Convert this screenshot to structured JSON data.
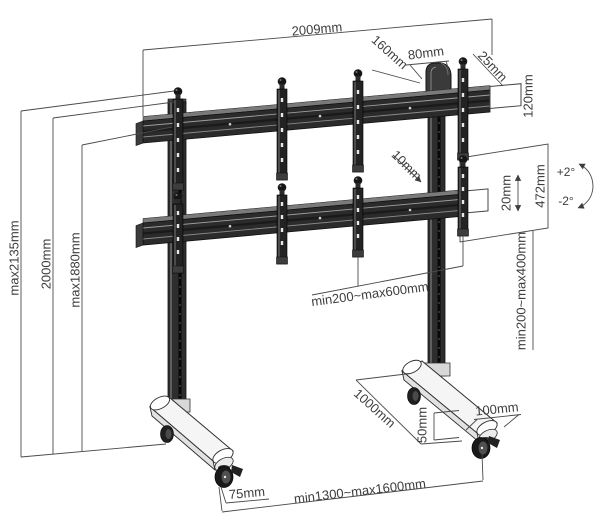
{
  "diagram": {
    "background": "#ffffff",
    "line_color": "#4a4a4a",
    "text_color": "#3d3d3d",
    "structure_color": "#2b2b2b",
    "dimensions": {
      "width_total": "2009mm",
      "top_offset": "160mm",
      "handle_width": "80mm",
      "end_gap": "25mm",
      "rail_height": "120mm",
      "height_max": "max2135mm",
      "height_column": "2000mm",
      "height_rail": "max1880mm",
      "strip_gap": "10mm",
      "fine_adjust": "20mm",
      "strip_length": "472mm",
      "tilt_up": "+2°",
      "tilt_down": "-2°",
      "vesa_width_range": "min200~max600mm",
      "vesa_height_range": "min200~max400mm",
      "base_depth": "1000mm",
      "foot_height": "50mm",
      "foot_width": "100mm",
      "wheel_width": "75mm",
      "base_width_range": "min1300~max1600mm"
    }
  }
}
